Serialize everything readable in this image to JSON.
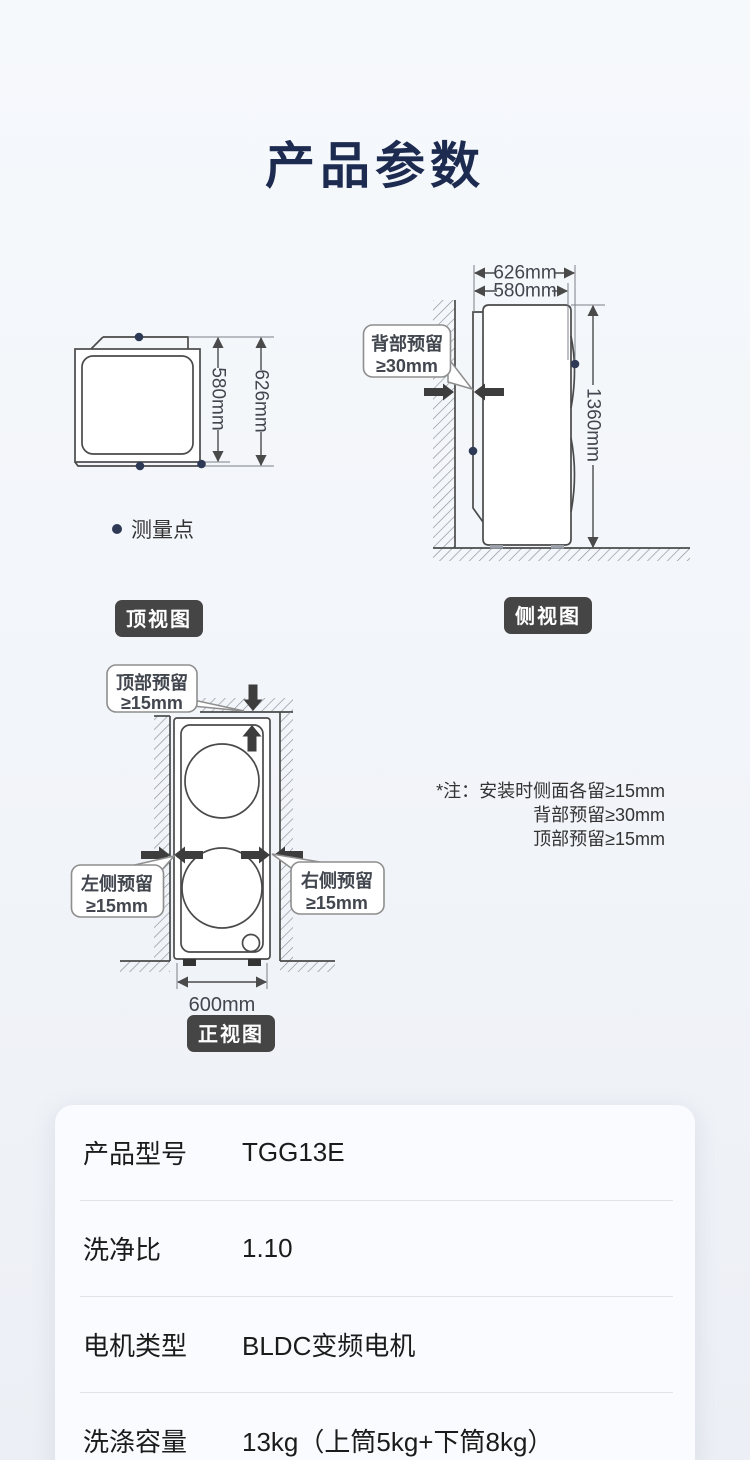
{
  "title": "产品参数",
  "legend": {
    "measure_point": "测量点"
  },
  "views": {
    "top": {
      "badge": "顶视图",
      "dim_inner": "580mm",
      "dim_outer": "626mm"
    },
    "side": {
      "badge": "侧视图",
      "dim_outer": "626mm",
      "dim_inner": "580mm",
      "dim_height": "1360mm",
      "callout_back": {
        "line1": "背部预留",
        "line2": "≥30mm"
      }
    },
    "front": {
      "badge": "正视图",
      "dim_width": "600mm",
      "callout_top": {
        "line1": "顶部预留",
        "line2": "≥15mm"
      },
      "callout_left": {
        "line1": "左侧预留",
        "line2": "≥15mm"
      },
      "callout_right": {
        "line1": "右侧预留",
        "line2": "≥15mm"
      }
    }
  },
  "install_note": {
    "line1": "*注：安装时侧面各留≥15mm",
    "line2": "背部预留≥30mm",
    "line3": "顶部预留≥15mm"
  },
  "spec_table": {
    "rows": [
      {
        "label": "产品型号",
        "value": "TGG13E"
      },
      {
        "label": "洗净比",
        "value": "1.10"
      },
      {
        "label": "电机类型",
        "value": "BLDC变频电机"
      },
      {
        "label": "洗涤容量",
        "value": "13kg（上筒5kg+下筒8kg）"
      }
    ]
  },
  "colors": {
    "title": "#1d2b50",
    "badge_bg": "#454545",
    "diagram_line": "#4a4a4a",
    "measure_dot": "#2e3a55",
    "card_bg": "#f9fbfe",
    "page_bg_top": "#f6f9fc",
    "page_bg_bottom": "#eceff5"
  }
}
